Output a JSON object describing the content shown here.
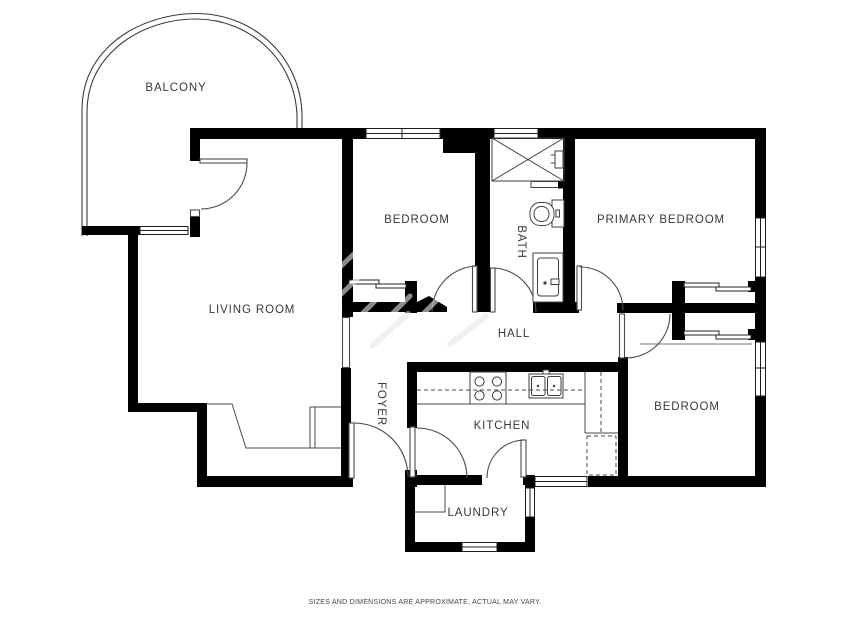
{
  "title": "Floor plan",
  "rooms": {
    "balcony": {
      "label": "BALCONY"
    },
    "living_room": {
      "label": "LIVING ROOM"
    },
    "bedroom": {
      "label": "BEDROOM"
    },
    "bath": {
      "label": "BATH"
    },
    "primary_bedroom": {
      "label": "PRIMARY BEDROOM"
    },
    "hall": {
      "label": "HALL"
    },
    "foyer": {
      "label": "FOYER"
    },
    "kitchen": {
      "label": "KITCHEN"
    },
    "bedroom_2": {
      "label": "BEDROOM"
    },
    "laundry": {
      "label": "LAUNDRY"
    }
  },
  "fixtures": [
    "shower",
    "toilet",
    "vanity-sink",
    "stove",
    "kitchen-sink"
  ],
  "meta": {
    "disclaimer": "SIZES AND DIMENSIONS ARE APPROXIMATE, ACTUAL MAY VARY."
  },
  "colors": {
    "wall": "#000000",
    "line": "#4a4a4a",
    "background": "#ffffff",
    "label": "#383838"
  }
}
